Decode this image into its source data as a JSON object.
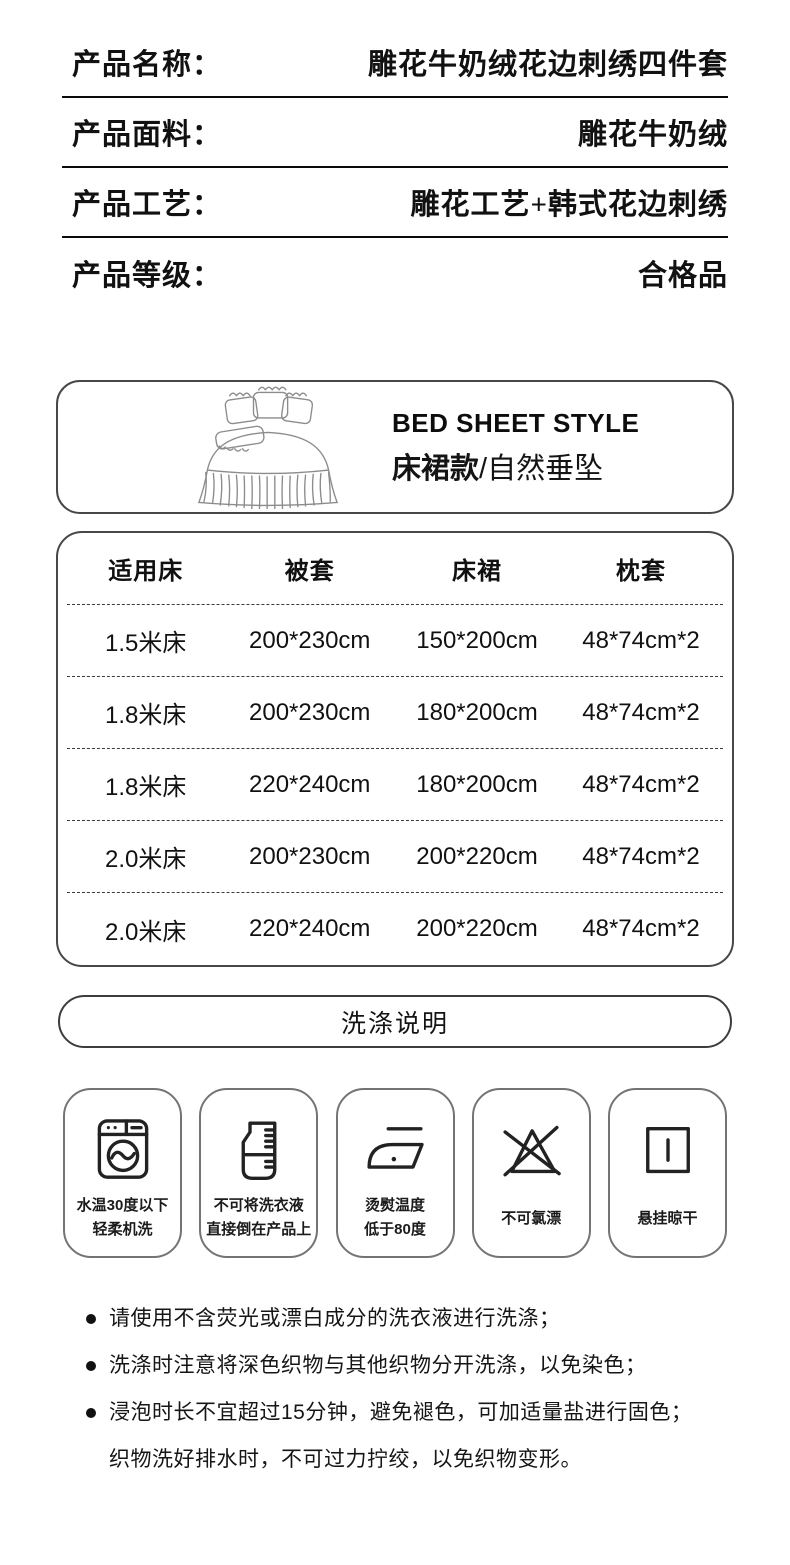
{
  "specs": [
    {
      "label": "产品名称：",
      "value": "雕花牛奶绒花边刺绣四件套"
    },
    {
      "label": "产品面料：",
      "value": "雕花牛奶绒"
    },
    {
      "label": "产品工艺：",
      "value": "雕花工艺+韩式花边刺绣"
    },
    {
      "label": "产品等级：",
      "value": "合格品"
    }
  ],
  "style_banner": {
    "title_en": "BED SHEET STYLE",
    "name_cn": "床裙款",
    "subtitle_cn": "/自然垂坠",
    "illustration": "bed-with-ruffled-skirt-line-art"
  },
  "size_table": {
    "headers": [
      "适用床",
      "被套",
      "床裙",
      "枕套"
    ],
    "rows": [
      [
        "1.5米床",
        "200*230cm",
        "150*200cm",
        "48*74cm*2"
      ],
      [
        "1.8米床",
        "200*230cm",
        "180*200cm",
        "48*74cm*2"
      ],
      [
        "1.8米床",
        "220*240cm",
        "180*200cm",
        "48*74cm*2"
      ],
      [
        "2.0米床",
        "200*230cm",
        "200*220cm",
        "48*74cm*2"
      ],
      [
        "2.0米床",
        "220*240cm",
        "200*220cm",
        "48*74cm*2"
      ]
    ]
  },
  "wash": {
    "header": "洗涤说明"
  },
  "care_icons": [
    {
      "icon": "washing-machine-icon",
      "label1": "水温30度以下",
      "label2": "轻柔机洗"
    },
    {
      "icon": "detergent-beaker-icon",
      "label1": "不可将洗衣液",
      "label2": "直接倒在产品上"
    },
    {
      "icon": "iron-icon",
      "label1": "烫熨温度",
      "label2": "低于80度"
    },
    {
      "icon": "no-bleach-icon",
      "label1": "不可氯漂",
      "label2": ""
    },
    {
      "icon": "hang-dry-icon",
      "label1": "悬挂晾干",
      "label2": ""
    }
  ],
  "notes": [
    {
      "text": "请使用不含荧光或漂白成分的洗衣液进行洗涤；"
    },
    {
      "text": "洗涤时注意将深色织物与其他织物分开洗涤，以免染色；"
    },
    {
      "text": "浸泡时长不宜超过15分钟，避免褪色，可加适量盐进行固色；"
    },
    {
      "text": "织物洗好排水时，不可过力拧绞，以免织物变形。"
    }
  ],
  "colors": {
    "ink": "#111111",
    "border_dark": "#474747",
    "border_light": "#747474"
  }
}
